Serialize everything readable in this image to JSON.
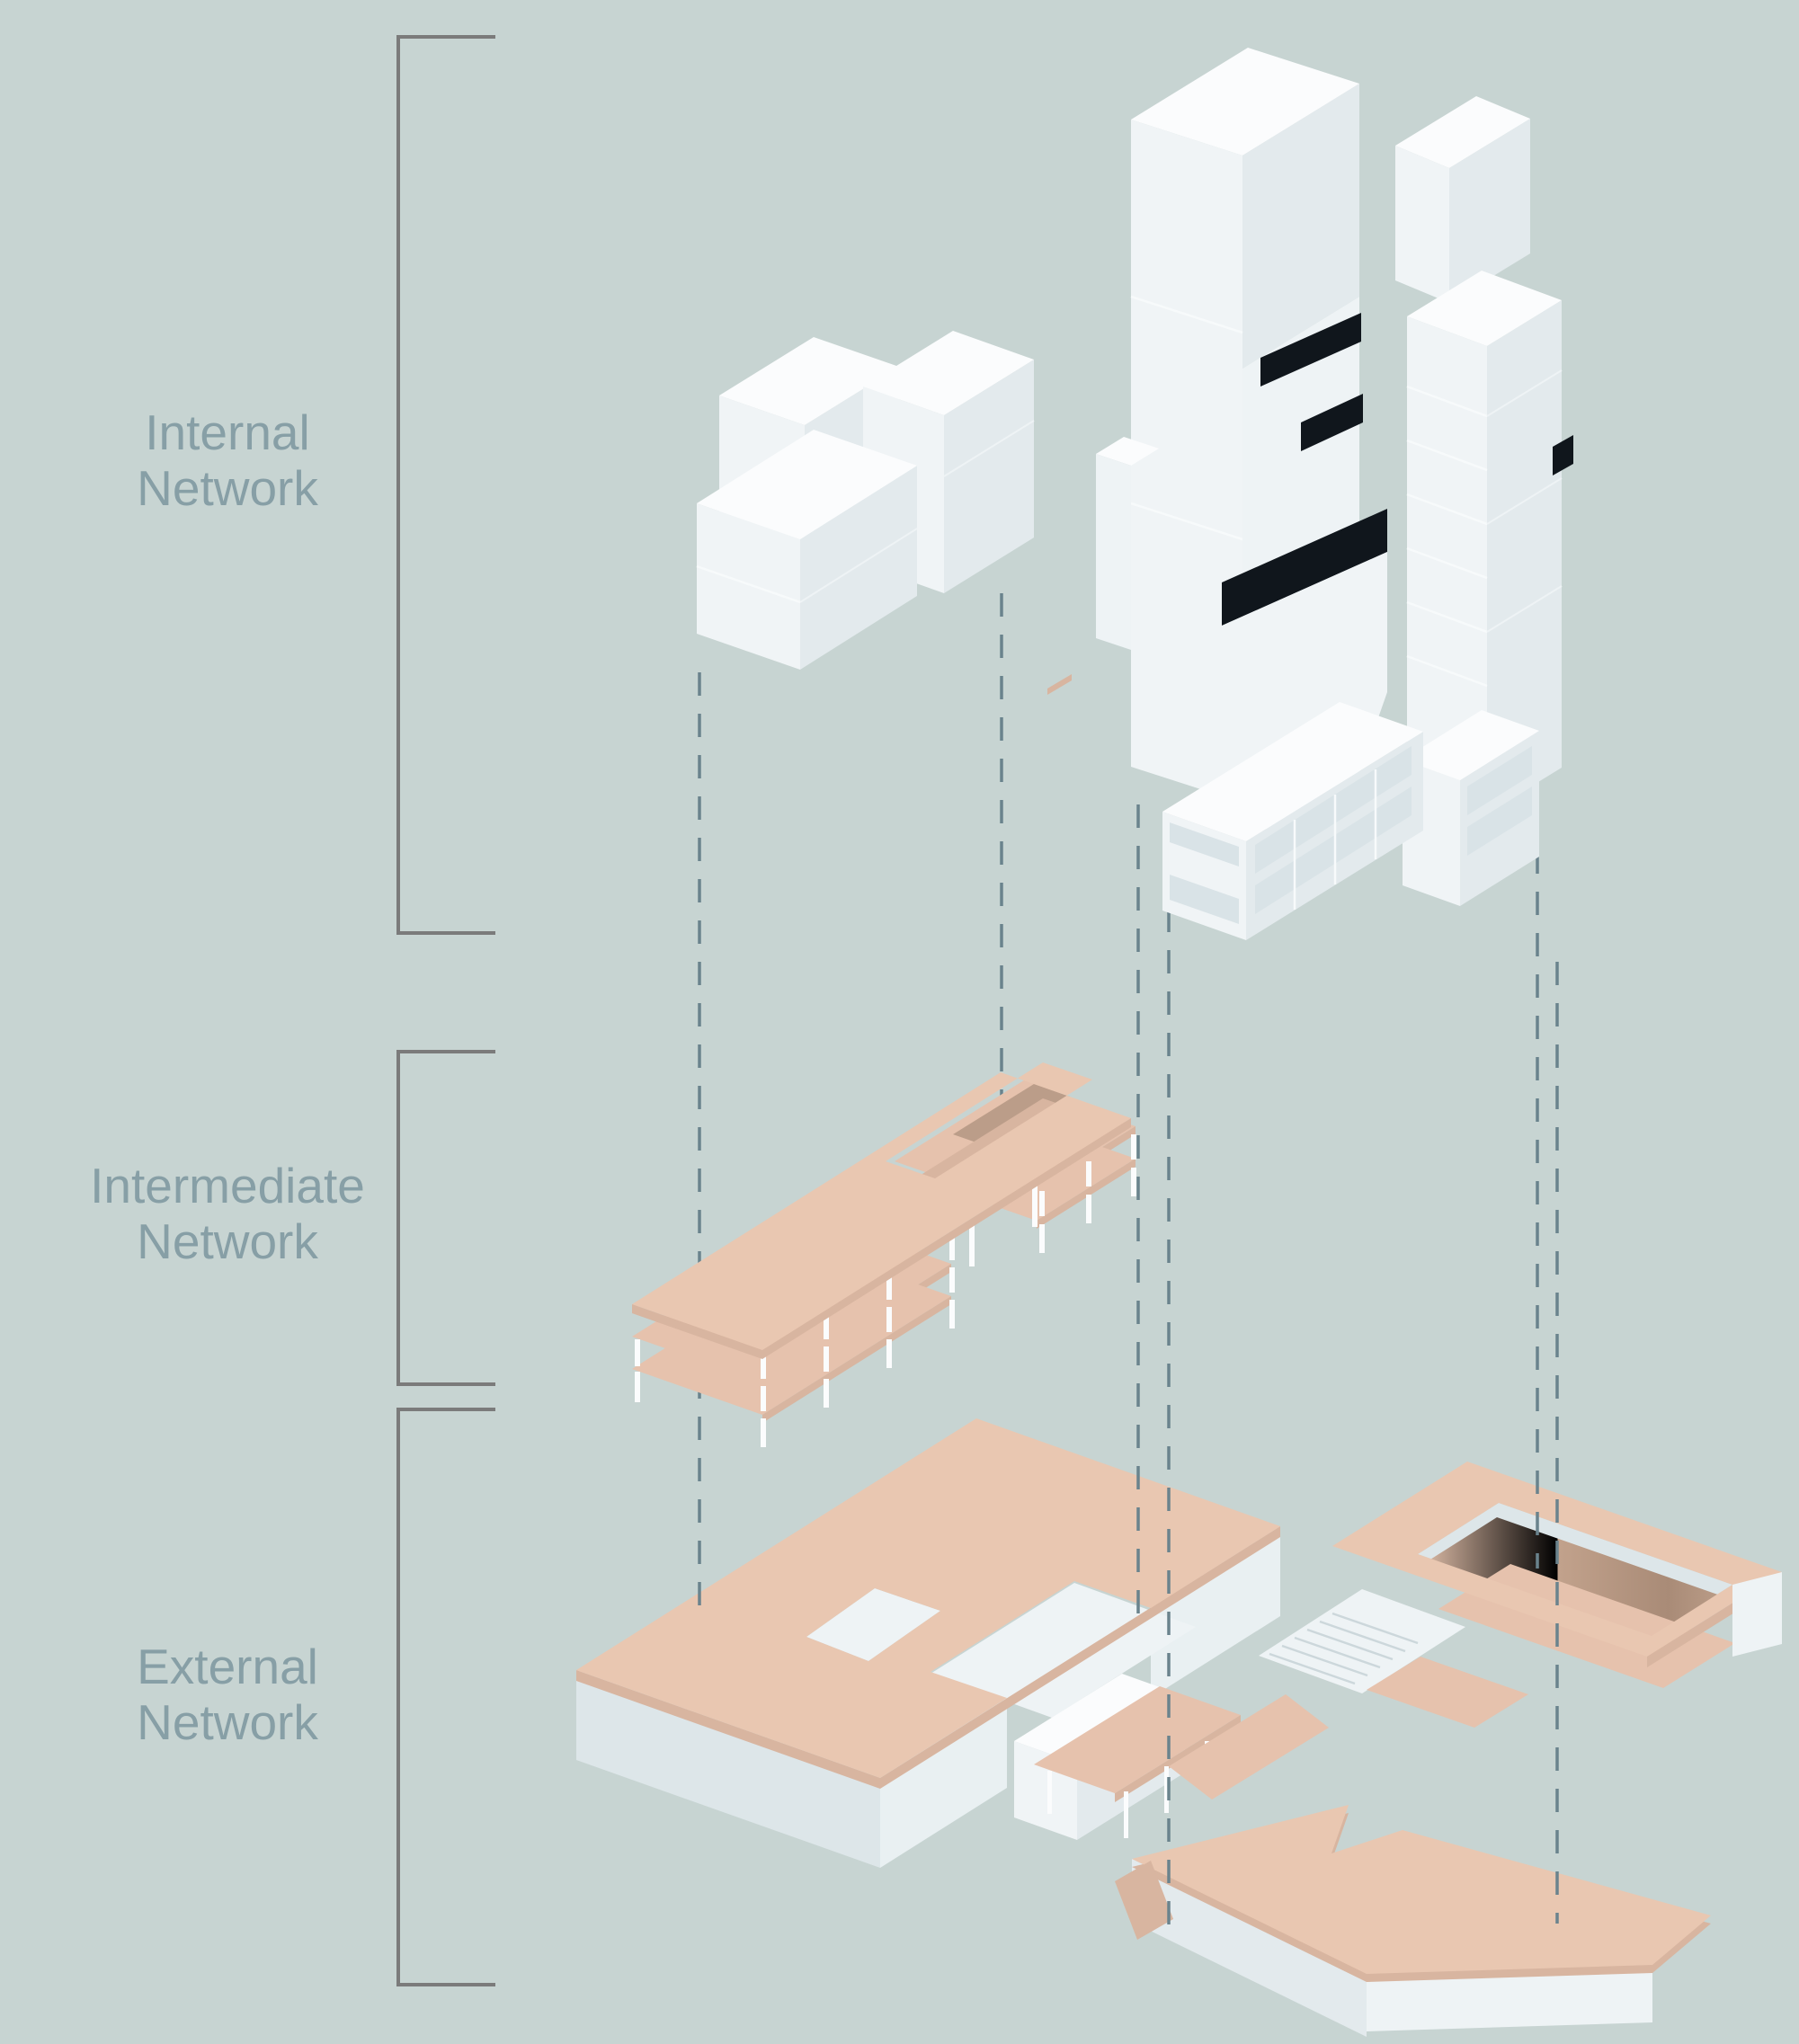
{
  "title": "Exploded axonometric network diagram",
  "levels": [
    {
      "id": "internal",
      "label_line1": "Internal",
      "label_line2": "Network"
    },
    {
      "id": "intermediate",
      "label_line1": "Intermediate",
      "label_line2": "Network"
    },
    {
      "id": "external",
      "label_line1": "External",
      "label_line2": "Network"
    }
  ],
  "colors": {
    "bg": "#c7d4d2",
    "label": "#879fa6",
    "bracket": "#7b7b7b",
    "dash": "#6a838d",
    "pink": "#e9c7b1",
    "pink_mid": "#e6c2ad",
    "pink_edge": "#d8b5a0",
    "pink_dark": "#bb9d89",
    "ramp_shadow": "#a98b77",
    "white_top": "#fbfcfd",
    "white_lf": "#f0f4f6",
    "white_rf": "#e3eaed",
    "glaze": "#d9e3e7",
    "panel": "#eef3f5",
    "wall": "#dde6e9",
    "wall_lit": "#e9f0f2",
    "black": "#10161c"
  }
}
